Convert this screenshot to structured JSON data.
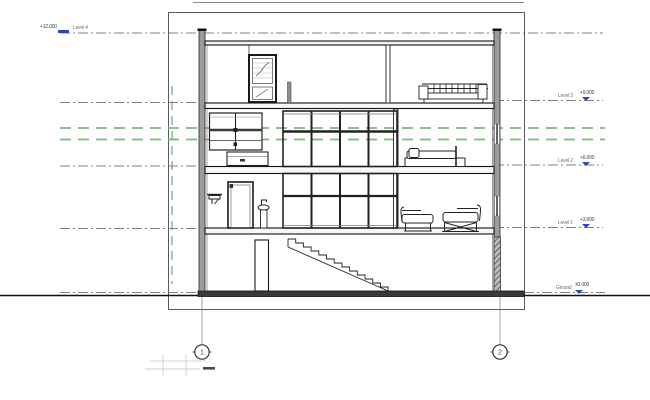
{
  "drawing": {
    "type": "architectural-building-section",
    "description": "Multi-storey building cross section with level annotations, stairs, curtain wall and furniture"
  },
  "levels": [
    {
      "name": "Level 4",
      "elevation": "+12.000"
    },
    {
      "name": "Level 3",
      "elevation": "+9.000"
    },
    {
      "name": "Level 2",
      "elevation": "+6.000"
    },
    {
      "name": "Level 1",
      "elevation": "+3.000"
    },
    {
      "name": "Ground",
      "elevation": "±0.000"
    }
  ],
  "grids": [
    {
      "label": "1"
    },
    {
      "label": "2"
    }
  ],
  "colors": {
    "annotation_blue": "#2b46c8",
    "grid_line_green": "#7cb87c",
    "wall_poche_gray": "#9c9c9c",
    "line_dark": "#1a1a1a"
  }
}
